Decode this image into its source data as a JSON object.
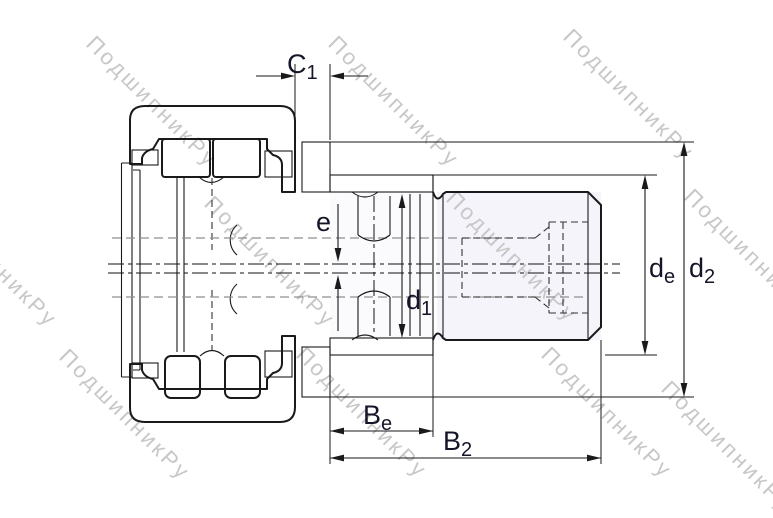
{
  "watermark": {
    "text": "ПодшипникРу",
    "color": "#c7c7c7"
  },
  "dimension_labels": {
    "c1": {
      "base": "C",
      "sub": "1"
    },
    "e": {
      "base": "e",
      "sub": ""
    },
    "d1": {
      "base": "d",
      "sub": "1"
    },
    "be": {
      "base": "B",
      "sub": "e"
    },
    "b2": {
      "base": "B",
      "sub": "2"
    },
    "de": {
      "base": "d",
      "sub": "e"
    },
    "d2": {
      "base": "d",
      "sub": "2"
    }
  },
  "colors": {
    "line": "#1a1a1a",
    "hidden_line_gray": "#8f8f8f",
    "hidden_line_black": "#333333",
    "label_text": "#15152a",
    "watermark": "#c7c7c7",
    "thread_fill": "#f6f4fb",
    "collar_fill": "#fbfafd",
    "seal_fill": "#e0e0e0",
    "background": "#ffffff"
  }
}
